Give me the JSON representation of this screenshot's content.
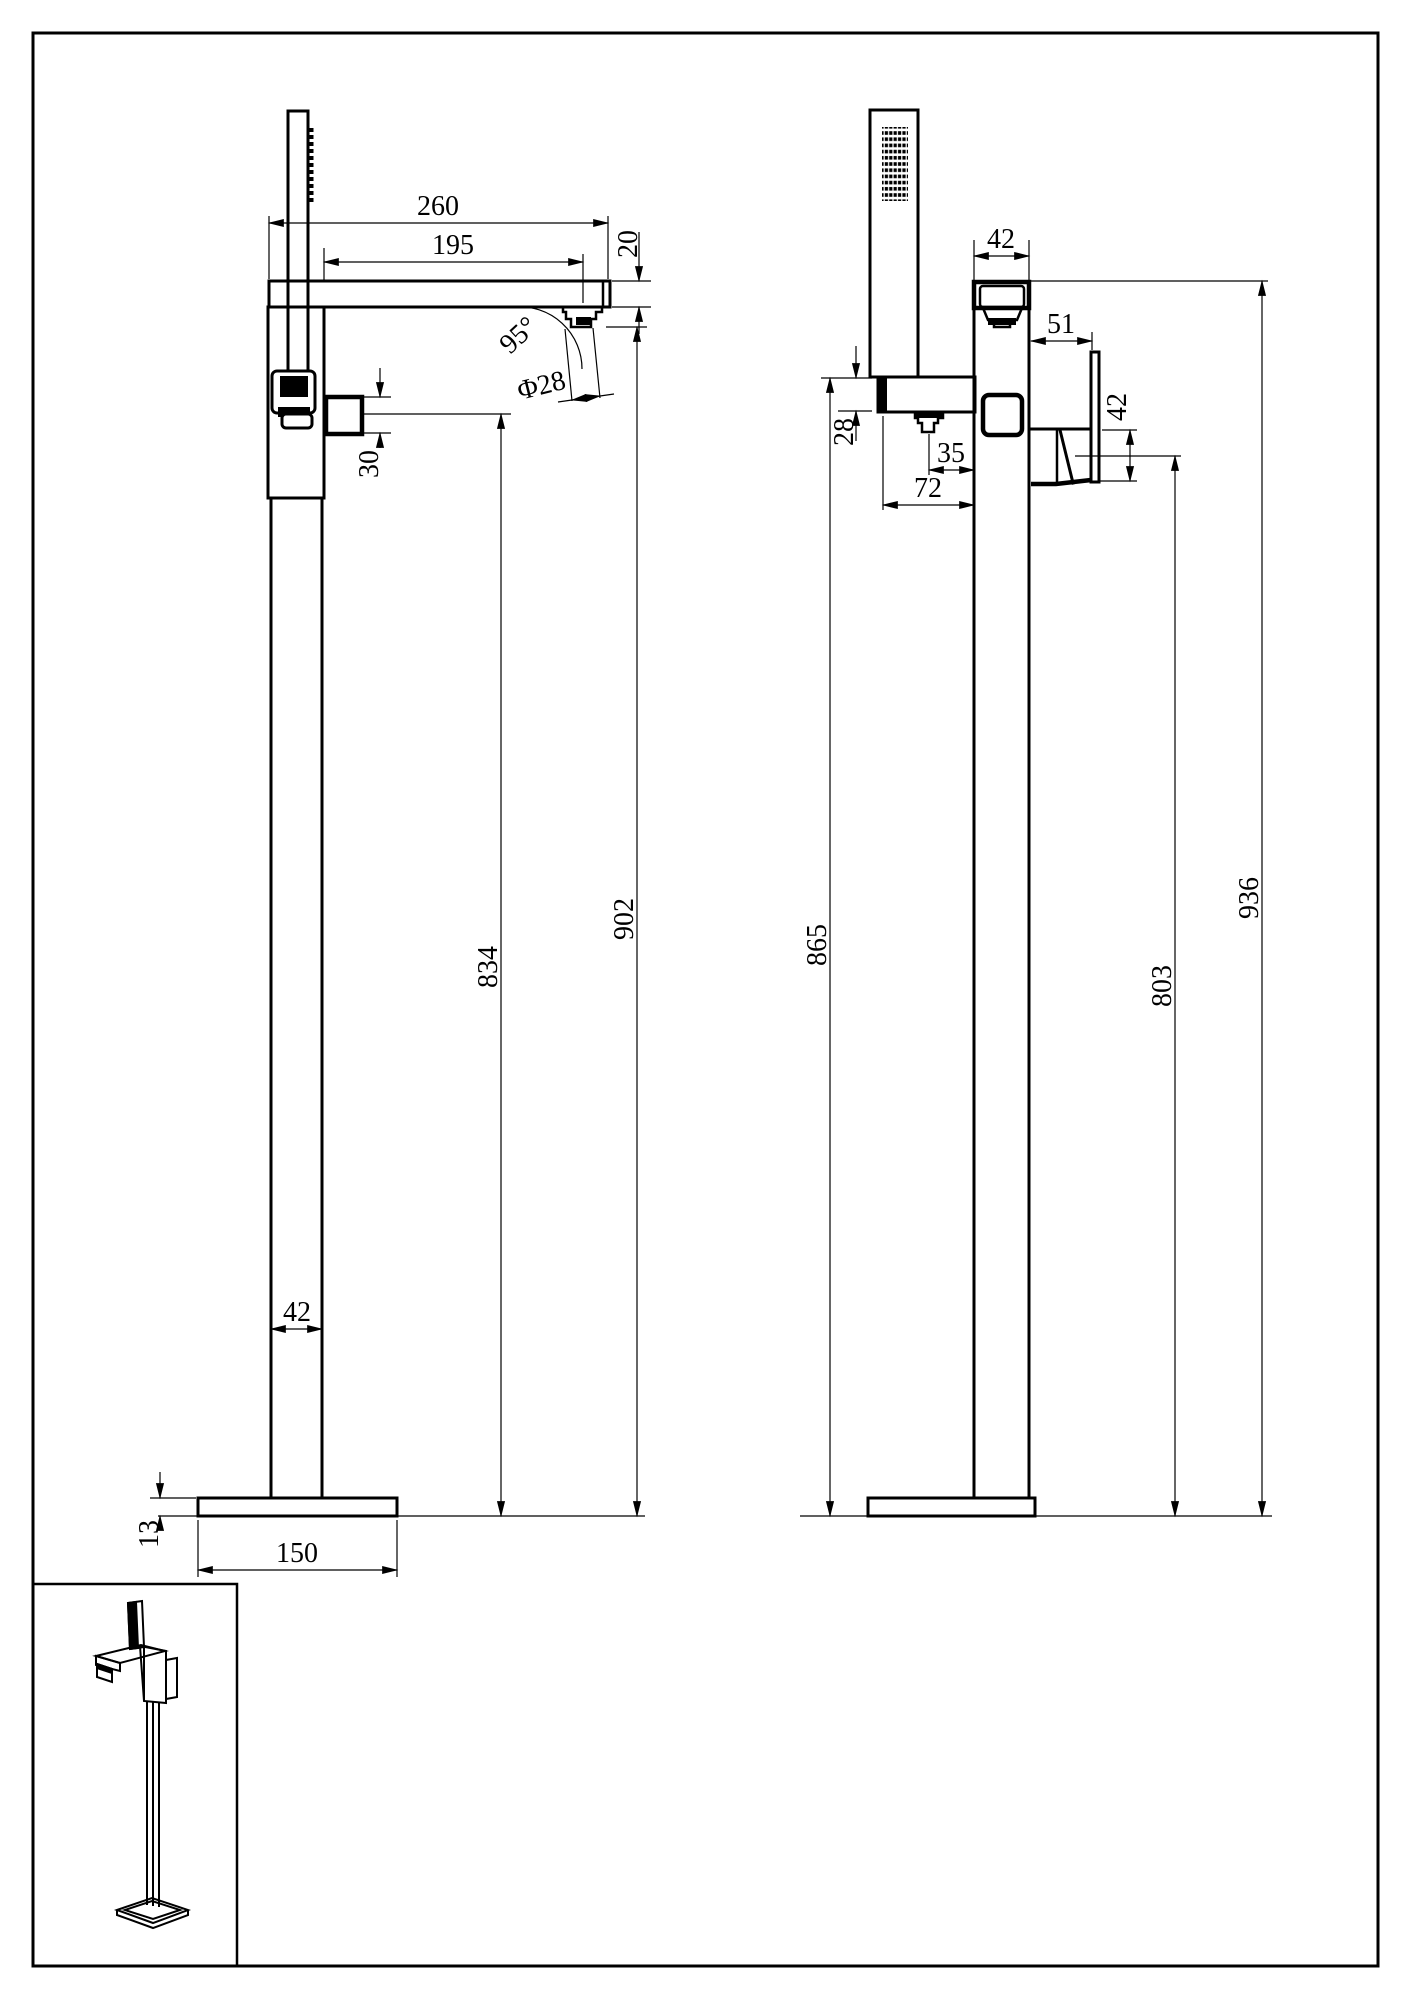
{
  "drawing": {
    "type": "technical-dimension-drawing",
    "subject": "freestanding bathtub faucet with hand shower",
    "colors": {
      "ink": "#000000",
      "paper": "#ffffff"
    },
    "side_view": {
      "dims": {
        "arm_overall": "260",
        "spout_reach": "195",
        "arm_thickness": "20",
        "spout_angle": "95°",
        "outlet_diameter": "Φ28",
        "side_outlet_height": "30",
        "outlet_to_floor": "834",
        "spout_to_floor": "902",
        "column_width": "42",
        "base_thickness": "13",
        "base_width": "150"
      }
    },
    "front_view": {
      "dims": {
        "spout_width": "42",
        "handle_reach": "51",
        "handle_height": "42",
        "holder_height": "28",
        "nozzle_offset": "35",
        "holder_reach": "72",
        "holder_to_floor": "865",
        "handle_to_floor": "803",
        "overall_height": "936"
      }
    }
  }
}
